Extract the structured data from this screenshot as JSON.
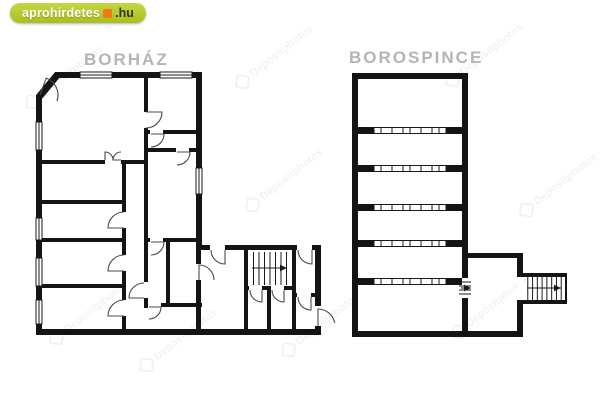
{
  "page": {
    "background": "#ffffff"
  },
  "logo": {
    "brand": "aprohirdetes",
    "tld": ".hu",
    "pill_color": "#b0c52c",
    "dot_color": "#ed7a17"
  },
  "colors": {
    "wall": "#141414",
    "door": "#4a4a4a",
    "detail": "#1a1a1a",
    "title": "#b4b4b4"
  },
  "watermark": {
    "text": "Depositphotos",
    "opacity": 0.1,
    "angle_deg": -38,
    "positions": [
      [
        62,
        82
      ],
      [
        272,
        62
      ],
      [
        482,
        60
      ],
      [
        282,
        185
      ],
      [
        556,
        190
      ],
      [
        86,
        318
      ],
      [
        176,
        345
      ],
      [
        318,
        330
      ],
      [
        488,
        312
      ]
    ]
  },
  "plans": [
    {
      "name": "borhaz",
      "title": "BORHÁZ",
      "walls": [
        [
          55,
          72,
          147,
          6
        ],
        [
          36,
          95,
          6,
          236
        ],
        [
          196,
          72,
          6,
          178
        ],
        [
          196,
          245,
          124,
          5
        ],
        [
          315,
          245,
          6,
          90
        ],
        [
          36,
          329,
          285,
          6
        ],
        [
          144,
          72,
          4,
          236
        ],
        [
          42,
          160,
          102,
          4
        ],
        [
          42,
          200,
          81,
          4
        ],
        [
          42,
          238,
          81,
          4
        ],
        [
          42,
          284,
          81,
          4
        ],
        [
          122,
          160,
          4,
          169
        ],
        [
          148,
          130,
          54,
          4
        ],
        [
          148,
          148,
          54,
          4
        ],
        [
          144,
          238,
          58,
          4
        ],
        [
          144,
          303,
          58,
          4
        ],
        [
          166,
          242,
          4,
          61
        ],
        [
          196,
          250,
          5,
          79
        ],
        [
          244,
          250,
          4,
          79
        ],
        [
          292,
          250,
          4,
          79
        ],
        [
          244,
          286,
          52,
          4
        ],
        [
          267,
          290,
          4,
          39
        ],
        [
          292,
          293,
          28,
          4
        ]
      ],
      "lines": [
        [
          39,
          97,
          58,
          74,
          7
        ]
      ],
      "openings": [
        [
          105,
          160,
          16,
          4
        ],
        [
          122,
          212,
          4,
          16
        ],
        [
          122,
          255,
          4,
          16
        ],
        [
          122,
          300,
          4,
          16
        ],
        [
          144,
          112,
          4,
          16
        ],
        [
          144,
          282,
          4,
          16
        ],
        [
          150,
          130,
          13,
          4
        ],
        [
          176,
          148,
          13,
          4
        ],
        [
          150,
          238,
          13,
          4
        ],
        [
          148,
          303,
          13,
          4
        ],
        [
          210,
          245,
          15,
          5
        ],
        [
          297,
          245,
          15,
          5
        ],
        [
          196,
          264,
          5,
          16
        ],
        [
          249,
          286,
          13,
          4
        ],
        [
          271,
          286,
          13,
          4
        ],
        [
          297,
          293,
          14,
          4
        ],
        [
          315,
          306,
          6,
          20
        ]
      ],
      "windows": [
        [
          80,
          72,
          32,
          6,
          "h"
        ],
        [
          160,
          72,
          32,
          6,
          "h"
        ],
        [
          36,
          122,
          6,
          28,
          "v"
        ],
        [
          36,
          218,
          6,
          22,
          "v"
        ],
        [
          36,
          258,
          6,
          28,
          "v"
        ],
        [
          36,
          300,
          6,
          24,
          "v"
        ],
        [
          196,
          168,
          6,
          26,
          "v"
        ]
      ],
      "doors": [
        [
          40,
          95,
          18,
          -70,
          20
        ],
        [
          105,
          160,
          8,
          270,
          360
        ],
        [
          121,
          160,
          8,
          180,
          270
        ],
        [
          124,
          228,
          16,
          180,
          270
        ],
        [
          124,
          271,
          16,
          180,
          270
        ],
        [
          124,
          316,
          16,
          180,
          270
        ],
        [
          146,
          112,
          16,
          0,
          90
        ],
        [
          151,
          134,
          13,
          0,
          90
        ],
        [
          177,
          152,
          13,
          0,
          90
        ],
        [
          151,
          242,
          13,
          0,
          90
        ],
        [
          149,
          307,
          12,
          0,
          90
        ],
        [
          144,
          298,
          15,
          180,
          270
        ],
        [
          225,
          250,
          14,
          90,
          180
        ],
        [
          312,
          250,
          14,
          90,
          180
        ],
        [
          199,
          280,
          15,
          270,
          360
        ],
        [
          262,
          290,
          12,
          90,
          180
        ],
        [
          284,
          290,
          12,
          90,
          180
        ],
        [
          311,
          297,
          13,
          90,
          180
        ],
        [
          318,
          326,
          17,
          270,
          350
        ]
      ],
      "stairs": [
        {
          "x": 248,
          "y": 252,
          "w": 44,
          "h": 33,
          "n": 7,
          "dir": "v",
          "arrow": [
            252,
            268,
            287,
            268
          ]
        }
      ]
    },
    {
      "name": "borospince",
      "title": "BOROSPINCE",
      "walls": [
        [
          352,
          73,
          116,
          6
        ],
        [
          352,
          73,
          6,
          264
        ],
        [
          462,
          73,
          6,
          184
        ],
        [
          462,
          257,
          6,
          21
        ],
        [
          462,
          298,
          6,
          39
        ],
        [
          462,
          253,
          61,
          5
        ],
        [
          517,
          253,
          6,
          84
        ],
        [
          352,
          331,
          171,
          6
        ],
        [
          358,
          127,
          16,
          7
        ],
        [
          446,
          127,
          16,
          7
        ],
        [
          358,
          165,
          16,
          7
        ],
        [
          446,
          165,
          16,
          7
        ],
        [
          358,
          204,
          16,
          7
        ],
        [
          446,
          204,
          16,
          7
        ],
        [
          358,
          240,
          16,
          7
        ],
        [
          446,
          240,
          16,
          7
        ],
        [
          358,
          278,
          16,
          7
        ],
        [
          446,
          278,
          16,
          7
        ],
        [
          523,
          273,
          43,
          4
        ],
        [
          523,
          300,
          43,
          4
        ]
      ],
      "lines": [
        [
          566,
          273,
          566,
          304,
          2
        ]
      ],
      "openings": [
        [
          517,
          277,
          6,
          23
        ]
      ],
      "windows": [],
      "doors": [],
      "racks": {
        "x1": 374,
        "x2": 446,
        "h": 7,
        "ys": [
          127,
          165,
          204,
          240,
          278
        ],
        "ticks": [
          0,
          7,
          18,
          29,
          36,
          47,
          58,
          65,
          72
        ]
      },
      "stairs": [
        {
          "x": 523,
          "y": 277,
          "w": 43,
          "h": 23,
          "n": 8,
          "dir": "v",
          "arrow": [
            527,
            288,
            561,
            288
          ]
        },
        {
          "x": 459,
          "y": 278,
          "w": 12,
          "h": 20,
          "n": 4,
          "dir": "h",
          "arrow": [
            461,
            288,
            471,
            288
          ]
        }
      ]
    }
  ]
}
